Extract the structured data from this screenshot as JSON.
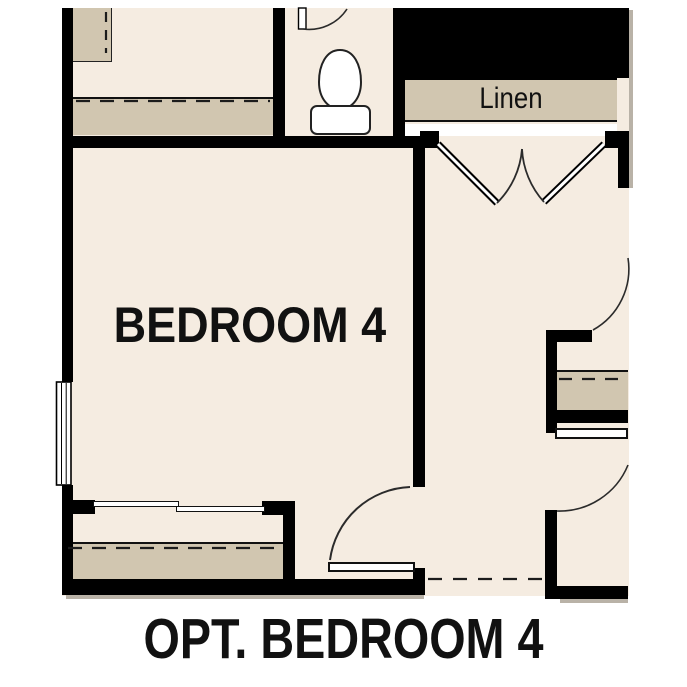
{
  "plan": {
    "caption": "OPT. BEDROOM 4",
    "rooms": {
      "bedroom_label": "BEDROOM 4",
      "linen_label": "Linen"
    },
    "fixtures": [
      "toilet",
      "window",
      "double-swing-closet-doors",
      "bypass-closet-doors",
      "hinged-door",
      "shelf-with-rod",
      "dresser"
    ],
    "colors": {
      "floor": "#f5ece1",
      "shelf": "#d1c6b0",
      "wall": "#000000",
      "line": "#2b2b2b",
      "bg": "#ffffff",
      "ink": "#111111"
    }
  }
}
